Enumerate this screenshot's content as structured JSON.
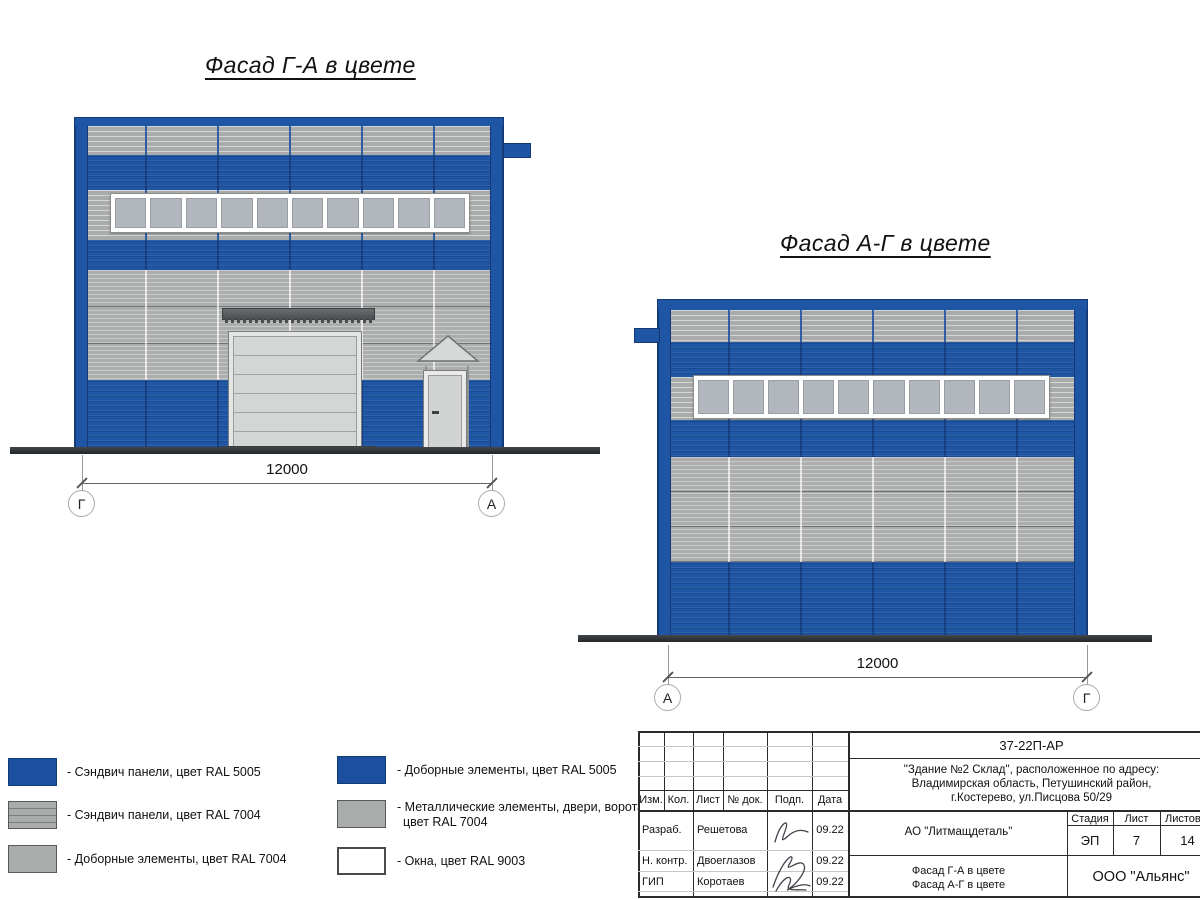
{
  "colors": {
    "ral5005_blue": "#1E55A4",
    "ral7004_gray": "#A9ACAA",
    "ral9003_white": "#FFFFFF",
    "glass_pane": "#B2B7BD",
    "door_gray": "#D4D6D5",
    "ground_dark": "#303335"
  },
  "facade_left": {
    "title": "Фасад Г-А в цвете",
    "dimension": "12000",
    "axis_left": "Г",
    "axis_right": "А"
  },
  "facade_right": {
    "title": "Фасад А-Г в цвете",
    "dimension": "12000",
    "axis_left": "А",
    "axis_right": "Г"
  },
  "legend": {
    "col1": [
      {
        "label": "- Сэндвич панели, цвет RAL 5005",
        "swatch": "blue"
      },
      {
        "label": "- Сэндвич панели, цвет RAL 7004",
        "swatch": "gray-ribbed"
      },
      {
        "label": "- Доборные элементы, цвет RAL 7004",
        "swatch": "gray"
      }
    ],
    "col2": [
      {
        "label": "- Доборные элементы, цвет RAL 5005",
        "swatch": "blue"
      },
      {
        "label": "- Металлические элементы, двери, ворота,",
        "label2": "цвет RAL 7004",
        "swatch": "gray"
      },
      {
        "label": "- Окна, цвет RAL 9003",
        "swatch": "white"
      }
    ]
  },
  "title_block": {
    "doc_number": "37-22П-АР",
    "address_lines": [
      "\"Здание №2 Склад\", расположенное по адресу:",
      "Владимирская область, Петушинский район,",
      "г.Костерево, ул.Писцова 50/29"
    ],
    "col_headers": {
      "izm": "Изм.",
      "kol": "Кол.",
      "list": "Лист",
      "ndok": "№ док.",
      "podp": "Подп.",
      "data": "Дата"
    },
    "signers": [
      {
        "role": "Разраб.",
        "name": "Решетова",
        "date": "09.22"
      },
      {
        "role": "Н. контр.",
        "name": "Двоеглазов",
        "date": "09.22"
      },
      {
        "role": "ГИП",
        "name": "Коротаев",
        "date": "09.22"
      }
    ],
    "client_org": "АО \"Литмащдеталь\"",
    "stage_header": "Стадия",
    "sheet_header": "Лист",
    "sheets_header": "Листов",
    "stage": "ЭП",
    "sheet_number": "7",
    "sheets_total": "14",
    "sheet_title_line1": "Фасад Г-А в цвете",
    "sheet_title_line2": "Фасад А-Г в цвете",
    "design_org": "ООО \"Альянс\""
  }
}
